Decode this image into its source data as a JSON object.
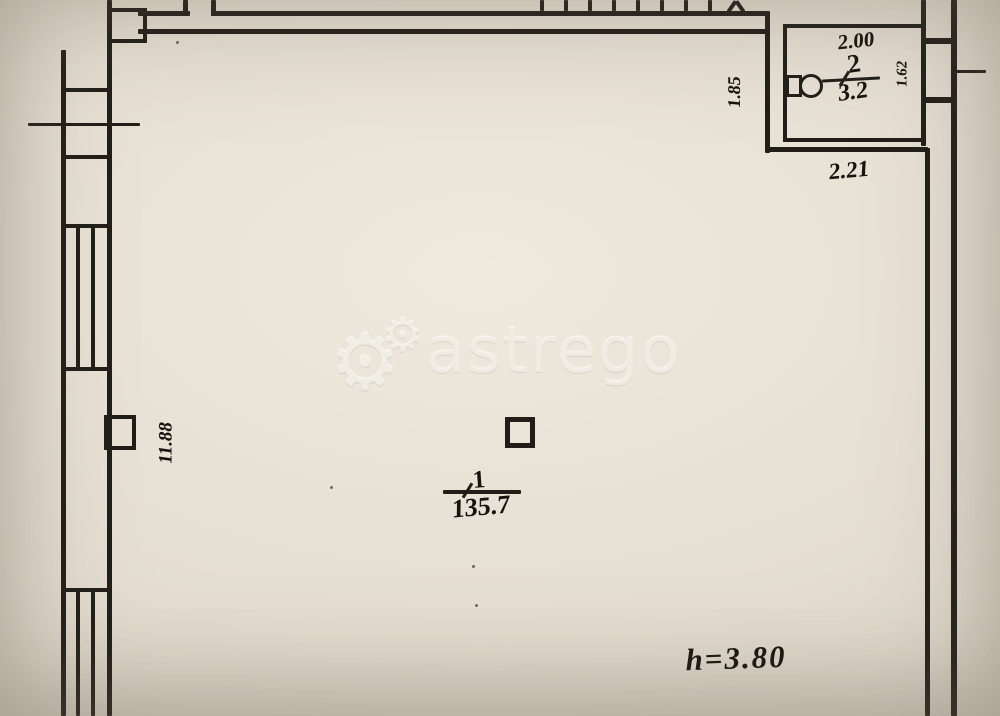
{
  "plan": {
    "watermark": {
      "text": "astrego",
      "icon": "gears-icon"
    },
    "rooms": {
      "room1": {
        "number": "1",
        "area": "135.7"
      },
      "room2": {
        "number": "2",
        "area": "3.2"
      }
    },
    "dimensions": {
      "room2_top": "2.00",
      "room2_bottom": "2.21",
      "room2_left": "1.85",
      "right_shaft": "1.62",
      "left_wall": "11.88",
      "height_note": "h=3.80"
    },
    "colors": {
      "paper": "#e6dfd3",
      "line": "#211e19",
      "watermark": "#f7f3ea"
    }
  }
}
